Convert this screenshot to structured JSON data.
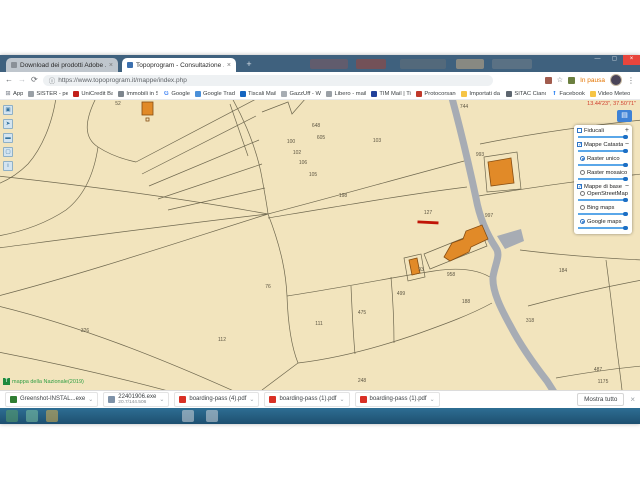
{
  "browser": {
    "tabs": [
      {
        "title": "Download dei prodotti Adobe ...",
        "active": false
      },
      {
        "title": "Topoprogram - Consultazione ...",
        "active": true
      }
    ],
    "url": "https://www.topoprogram.it/mappe/index.php",
    "paused_label": "In pausa",
    "bookmarks": [
      {
        "label": "App",
        "icon": "apps-grid-icon",
        "color": "#8a8f98",
        "glyph": "⊞"
      },
      {
        "label": "SISTER - per visual",
        "icon": "sister-icon",
        "color": "#9aa0a6",
        "glyph": ""
      },
      {
        "label": "UniCredit Banca Co...",
        "icon": "unicredit-icon",
        "color": "#c2201a",
        "glyph": ""
      },
      {
        "label": "Immobili in Sicilia",
        "icon": "immobili-icon",
        "color": "#7d858d",
        "glyph": ""
      },
      {
        "label": "Google",
        "icon": "google-icon",
        "color": "#4285f4",
        "glyph": "G"
      },
      {
        "label": "Google Traduttore",
        "icon": "translate-icon",
        "color": "#4a90d9",
        "glyph": ""
      },
      {
        "label": "Tiscali Mail",
        "icon": "tiscali-icon",
        "color": "#1565c0",
        "glyph": ""
      },
      {
        "label": "GazzUff - Web Links",
        "icon": "gazzuff-icon",
        "color": "#a7adb3",
        "glyph": ""
      },
      {
        "label": "Libero - mail",
        "icon": "libero-icon",
        "color": "#9aa0a6",
        "glyph": ""
      },
      {
        "label": "TIM Mail | TimLt_I I",
        "icon": "tim-icon",
        "color": "#20409a",
        "glyph": ""
      },
      {
        "label": "Protocorsancanave.it",
        "icon": "protoco-icon",
        "color": "#c0392b",
        "glyph": ""
      },
      {
        "label": "Importati da IE",
        "icon": "folder-icon",
        "color": "#f6c445",
        "glyph": ""
      },
      {
        "label": "SITAC Cianciana",
        "icon": "sitac-icon",
        "color": "#5d6670",
        "glyph": ""
      },
      {
        "label": "Facebook",
        "icon": "facebook-icon",
        "color": "#1877f2",
        "glyph": "f"
      },
      {
        "label": "Video Meteo Oggi -",
        "icon": "folder-icon",
        "color": "#f6c445",
        "glyph": ""
      },
      {
        "label": "»",
        "icon": "overflow-chevrons-icon",
        "color": "transparent",
        "glyph": "»"
      }
    ]
  },
  "map": {
    "coordinates_label": "13.44'23\", 37.50'71\"",
    "attribution": {
      "logo": "T",
      "text": "mappa della Nazionale(2019)"
    },
    "toolbar": [
      {
        "name": "screenshot-icon",
        "glyph": "▣"
      },
      {
        "name": "pointer-icon",
        "glyph": "➤"
      },
      {
        "name": "measure-icon",
        "glyph": "▬"
      },
      {
        "name": "area-icon",
        "glyph": "▢"
      },
      {
        "name": "info-icon",
        "glyph": "i"
      }
    ],
    "layers_button_glyph": "▤",
    "layers_panel": [
      {
        "type": "checkbox",
        "checked": false,
        "label": "Fiducali",
        "suffix": "+",
        "slider": true
      },
      {
        "type": "checkbox",
        "checked": true,
        "label": "Mappe Catastali",
        "suffix": "−",
        "slider": true
      },
      {
        "type": "radio",
        "checked": true,
        "label": "Raster unico",
        "indent": true,
        "slider": true
      },
      {
        "type": "radio",
        "checked": false,
        "label": "Raster mosaico",
        "indent": true,
        "slider": true
      },
      {
        "type": "checkbox",
        "checked": true,
        "label": "Mappe di base",
        "suffix": "−",
        "slider": false
      },
      {
        "type": "radio",
        "checked": false,
        "label": "OpenStreetMap",
        "indent": true,
        "slider": true
      },
      {
        "type": "radio",
        "checked": false,
        "label": "Bing maps",
        "indent": true,
        "slider": true
      },
      {
        "type": "radio",
        "checked": true,
        "label": "Google maps",
        "indent": true,
        "slider": true
      }
    ],
    "parcels": [
      {
        "n": "52",
        "x": 118,
        "y": 5
      },
      {
        "n": "648",
        "x": 316,
        "y": 27
      },
      {
        "n": "605",
        "x": 321,
        "y": 39
      },
      {
        "n": "100",
        "x": 291,
        "y": 43
      },
      {
        "n": "102",
        "x": 297,
        "y": 54
      },
      {
        "n": "106",
        "x": 303,
        "y": 64
      },
      {
        "n": "105",
        "x": 313,
        "y": 76
      },
      {
        "n": "103",
        "x": 377,
        "y": 42
      },
      {
        "n": "744",
        "x": 464,
        "y": 8
      },
      {
        "n": "198",
        "x": 343,
        "y": 97
      },
      {
        "n": "127",
        "x": 428,
        "y": 114
      },
      {
        "n": "997",
        "x": 489,
        "y": 117
      },
      {
        "n": "993",
        "x": 480,
        "y": 56
      },
      {
        "n": "93",
        "x": 421,
        "y": 171
      },
      {
        "n": "958",
        "x": 451,
        "y": 176
      },
      {
        "n": "499",
        "x": 401,
        "y": 195
      },
      {
        "n": "188",
        "x": 466,
        "y": 203
      },
      {
        "n": "475",
        "x": 362,
        "y": 214
      },
      {
        "n": "111",
        "x": 319,
        "y": 225
      },
      {
        "n": "112",
        "x": 222,
        "y": 241
      },
      {
        "n": "326",
        "x": 85,
        "y": 232
      },
      {
        "n": "76",
        "x": 268,
        "y": 188
      },
      {
        "n": "248",
        "x": 362,
        "y": 282
      },
      {
        "n": "184",
        "x": 563,
        "y": 172
      },
      {
        "n": "318",
        "x": 530,
        "y": 222
      },
      {
        "n": "487",
        "x": 598,
        "y": 271
      },
      {
        "n": "1175",
        "x": 603,
        "y": 283
      }
    ],
    "colors": {
      "parcel_fill": "#f2e4bd",
      "road": "#a7acb4",
      "building": "#e18a28",
      "highlight_line": "#c01407",
      "accent_blue": "#2e75c6"
    }
  },
  "downloads": {
    "items": [
      {
        "label": "Greenshot-INSTAL...exe",
        "icon": "greenshot-file-icon",
        "color": "#2f7d32",
        "sub": ""
      },
      {
        "label": "22401906.exe",
        "sub": "20.7/144.506",
        "icon": "exe-file-icon",
        "color": "#7e92a8"
      },
      {
        "label": "boarding-pass (4).pdf",
        "icon": "pdf-file-icon",
        "color": "#d93025",
        "sub": ""
      },
      {
        "label": "boarding-pass (1).pdf",
        "icon": "pdf-file-icon",
        "color": "#d93025",
        "sub": ""
      },
      {
        "label": "boarding-pass (1).pdf",
        "icon": "pdf-file-icon",
        "color": "#d93025",
        "sub": ""
      }
    ],
    "show_all_label": "Mostra tutto"
  }
}
